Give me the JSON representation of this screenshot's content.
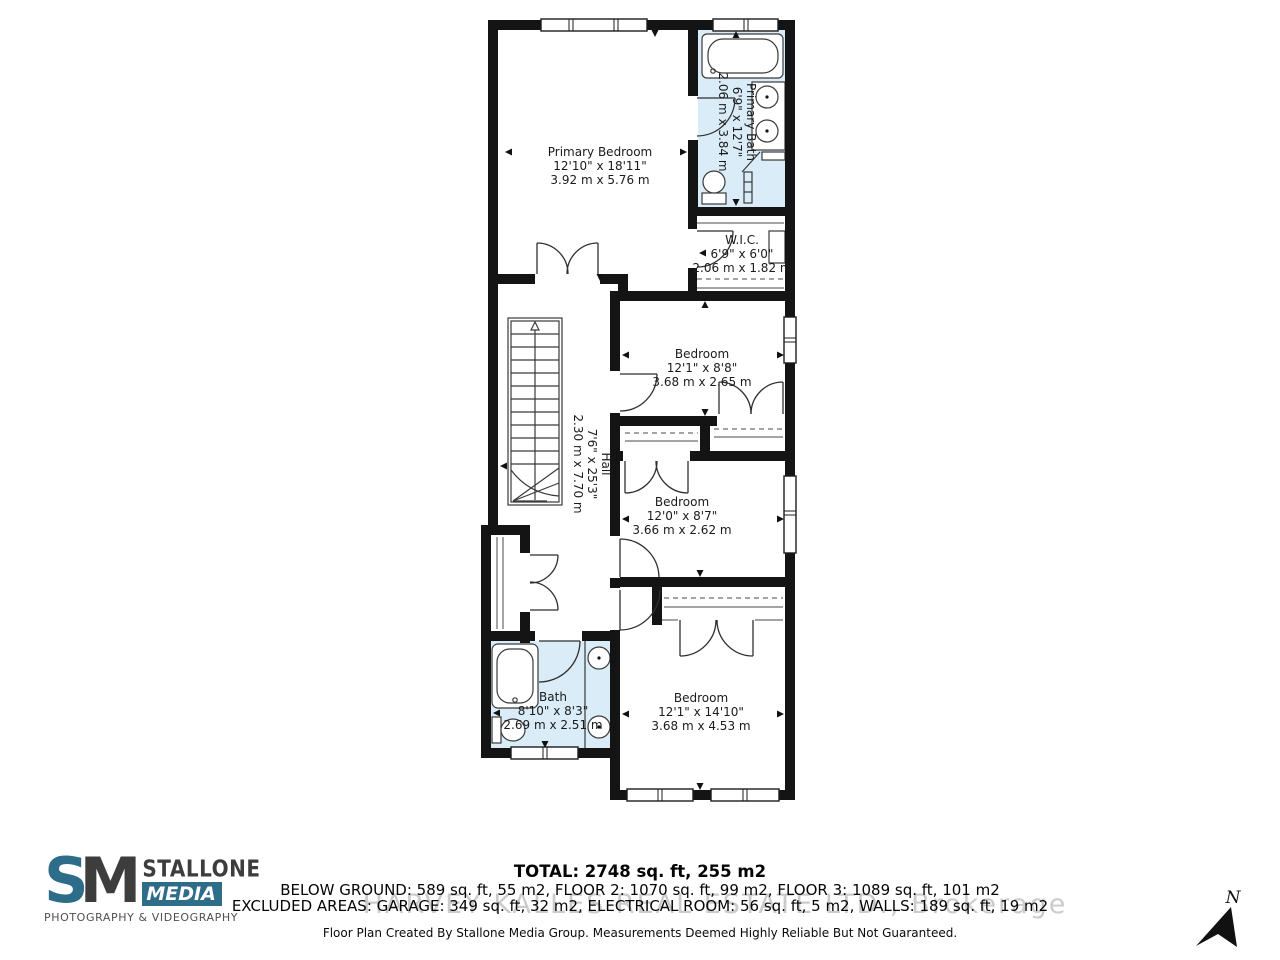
{
  "plan": {
    "rooms": {
      "primary_bedroom": {
        "name": "Primary Bedroom",
        "imperial": "12'10\" x 18'11\"",
        "metric": "3.92 m x 5.76 m"
      },
      "primary_bath": {
        "name": "Primary Bath",
        "imperial": "6'9\" x 12'7\"",
        "metric": "2.06 m x 3.84 m"
      },
      "wic": {
        "name": "W.I.C.",
        "imperial": "6'9\" x 6'0\"",
        "metric": "2.06 m x 1.82 m"
      },
      "bedroom_1": {
        "name": "Bedroom",
        "imperial": "12'1\" x 8'8\"",
        "metric": "3.68 m x 2.65 m"
      },
      "hall": {
        "name": "Hall",
        "imperial": "7'6\" x 25'3\"",
        "metric": "2.30 m x 7.70 m"
      },
      "bedroom_2": {
        "name": "Bedroom",
        "imperial": "12'0\" x 8'7\"",
        "metric": "3.66 m x 2.62 m"
      },
      "bath": {
        "name": "Bath",
        "imperial": "8'10\" x 8'3\"",
        "metric": "2.69 m x 2.51 m"
      },
      "bedroom_3": {
        "name": "Bedroom",
        "imperial": "12'1\" x 14'10\"",
        "metric": "3.68 m x 4.53 m"
      }
    },
    "north_label": "N"
  },
  "footer": {
    "total": "TOTAL: 2748 sq. ft, 255 m2",
    "floors": "BELOW GROUND: 589 sq. ft, 55 m2, FLOOR 2: 1070 sq. ft, 99 m2, FLOOR 3: 1089 sq. ft, 101 m2",
    "excluded": "EXCLUDED AREAS: GARAGE: 349 sq. ft, 32 m2, ELECTRICAL ROOM: 56 sq. ft, 5 m2, WALLS: 189 sq. ft, 19 m2",
    "watermark": "HARVEY KALLES REAL ESTATE LTD., Brokerage",
    "disclaimer": "Floor Plan Created By Stallone Media Group. Measurements Deemed Highly Reliable But Not Guaranteed."
  },
  "logo": {
    "monogram_s": "S",
    "monogram_m": "M",
    "name_line1": "STALLONE",
    "name_line2": "MEDIA",
    "tagline": "PHOTOGRAPHY & VIDEOGRAPHY"
  },
  "colors": {
    "wall": "#141414",
    "bath_fill": "#d9ecf7",
    "logo_teal": "#2e6d8a",
    "logo_dark": "#3d3d3d"
  }
}
